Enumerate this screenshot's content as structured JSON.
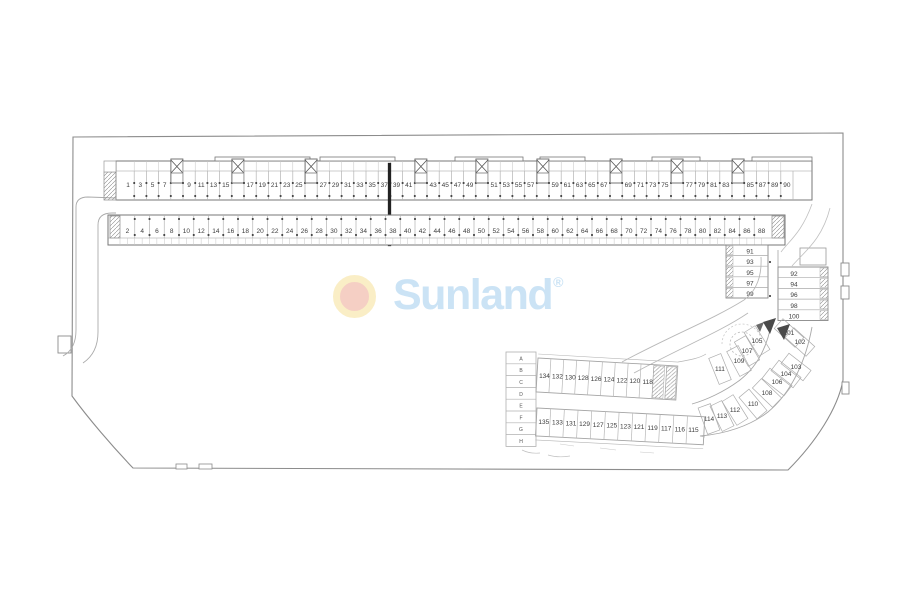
{
  "brand": {
    "name": "Sunland",
    "registered_mark": "®",
    "ring_color": "#faeec6",
    "core_color": "#f5cfc4",
    "wordmark_color": "#cbe3f5"
  },
  "floorplan": {
    "line_color": "#a8a8a8",
    "outline_color": "#8c8c8c",
    "number_color": "#3c3c3c",
    "row1_units": [
      "1",
      "3",
      "5",
      "7",
      "stair",
      "9",
      "11",
      "13",
      "15",
      "stair",
      "17",
      "19",
      "21",
      "23",
      "25",
      "stair",
      "27",
      "29",
      "31",
      "33",
      "35",
      "37",
      "39",
      "41",
      "stair",
      "43",
      "45",
      "47",
      "49",
      "stair",
      "51",
      "53",
      "55",
      "57",
      "stair",
      "59",
      "61",
      "63",
      "65",
      "67",
      "stair",
      "69",
      "71",
      "73",
      "75",
      "stair",
      "77",
      "79",
      "81",
      "83",
      "stair",
      "85",
      "87",
      "89",
      "90"
    ],
    "row2_units": [
      "2",
      "4",
      "6",
      "8",
      "10",
      "12",
      "14",
      "16",
      "18",
      "20",
      "22",
      "24",
      "26",
      "28",
      "30",
      "32",
      "34",
      "36",
      "38",
      "40",
      "42",
      "44",
      "46",
      "48",
      "50",
      "52",
      "54",
      "56",
      "58",
      "60",
      "62",
      "64",
      "66",
      "68",
      "70",
      "72",
      "74",
      "76",
      "78",
      "80",
      "82",
      "84",
      "86",
      "88"
    ],
    "right_inner_column_units": [
      "91",
      "93",
      "95",
      "97",
      "99"
    ],
    "right_outer_column_units": [
      "92",
      "94",
      "96",
      "98",
      "100"
    ],
    "curve_units": [
      "101",
      "102",
      "103",
      "104",
      "105",
      "106",
      "107",
      "108",
      "109",
      "110",
      "111",
      "112",
      "113",
      "114"
    ],
    "lower_upper_row_units": [
      "134",
      "132",
      "130",
      "128",
      "126",
      "124",
      "122",
      "120",
      "118"
    ],
    "lower_lower_row_units": [
      "135",
      "133",
      "131",
      "129",
      "127",
      "125",
      "123",
      "121",
      "119",
      "117",
      "116",
      "115"
    ],
    "storage_cells": [
      "A",
      "B",
      "C",
      "D",
      "E",
      "F",
      "G",
      "H"
    ]
  }
}
